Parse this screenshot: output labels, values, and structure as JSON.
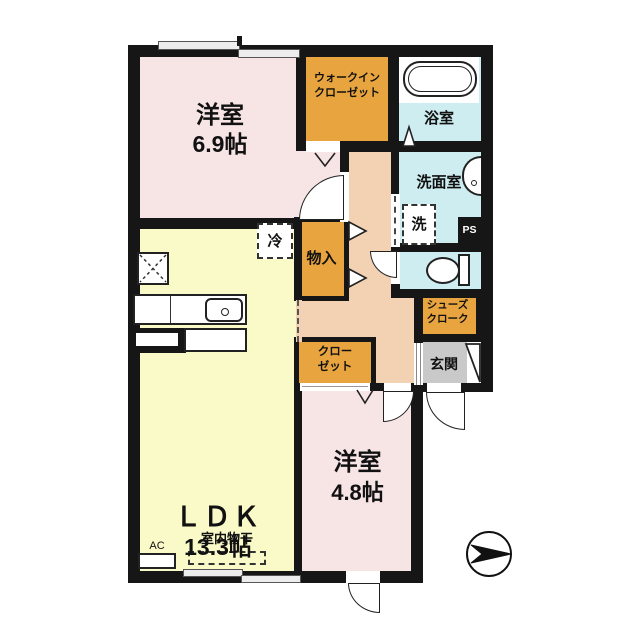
{
  "title": "apartment-floorplan",
  "colors": {
    "wall": "#161616",
    "room_pink": "#f7e5e6",
    "ldk_yellow": "#fafac9",
    "closet_orange": "#e8a43e",
    "wet_blue": "#cdedf1",
    "hall_peach": "#f3d2b4",
    "entry_gray": "#c9c9c9"
  },
  "rooms": {
    "bedroom_main": {
      "name": "洋室",
      "size": "6.9帖"
    },
    "walk_in_closet": {
      "line1": "ウォークイン",
      "line2": "クローゼット"
    },
    "bathroom": {
      "name": "浴室"
    },
    "washroom": {
      "name": "洗面室"
    },
    "washer": {
      "label": "洗"
    },
    "pipe_space": {
      "label": "PS"
    },
    "storage": {
      "label": "物入"
    },
    "fridge": {
      "label": "冷"
    },
    "shoe_closet": {
      "line1": "シューズ",
      "line2": "クローク"
    },
    "entrance": {
      "name": "玄関"
    },
    "closet": {
      "line1": "クロー",
      "line2": "ゼット"
    },
    "ldk": {
      "name": "ＬＤＫ",
      "size": "13.3帖"
    },
    "bedroom_small": {
      "name": "洋室",
      "size": "4.8帖"
    },
    "ac": {
      "label": "AC"
    },
    "indoor_drying": {
      "label": "室内物干"
    }
  }
}
